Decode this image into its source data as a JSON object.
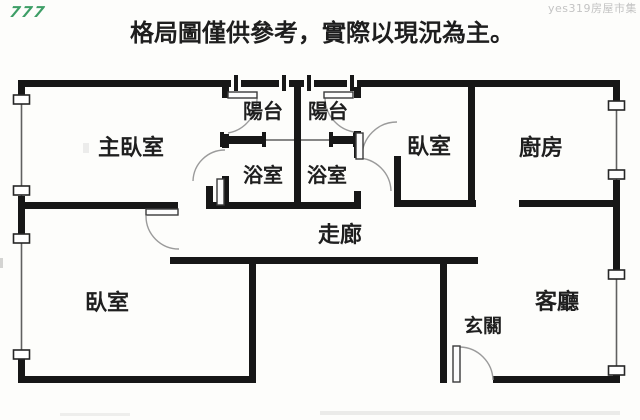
{
  "page": {
    "title": "格局圖僅供參考，實際以現況為主。"
  },
  "watermarks": {
    "site_logo": "777",
    "site_name": "yes319房屋市集"
  },
  "colors": {
    "ink": "#1e1e1e",
    "wall": "#171717",
    "watermark_green": "#3d9e66",
    "watermark_gray": "#c3c3c3"
  },
  "rooms": {
    "master_bedroom": {
      "label": "主臥室"
    },
    "balcony_left": {
      "label": "陽台"
    },
    "balcony_right": {
      "label": "陽台"
    },
    "bathroom_left": {
      "label": "浴室"
    },
    "bathroom_right": {
      "label": "浴室"
    },
    "bedroom_top_right": {
      "label": "臥室"
    },
    "kitchen": {
      "label": "廚房"
    },
    "hallway": {
      "label": "走廊"
    },
    "bedroom_bottom_left": {
      "label": "臥室"
    },
    "entryway": {
      "label": "玄關"
    },
    "living_room": {
      "label": "客廳"
    }
  }
}
